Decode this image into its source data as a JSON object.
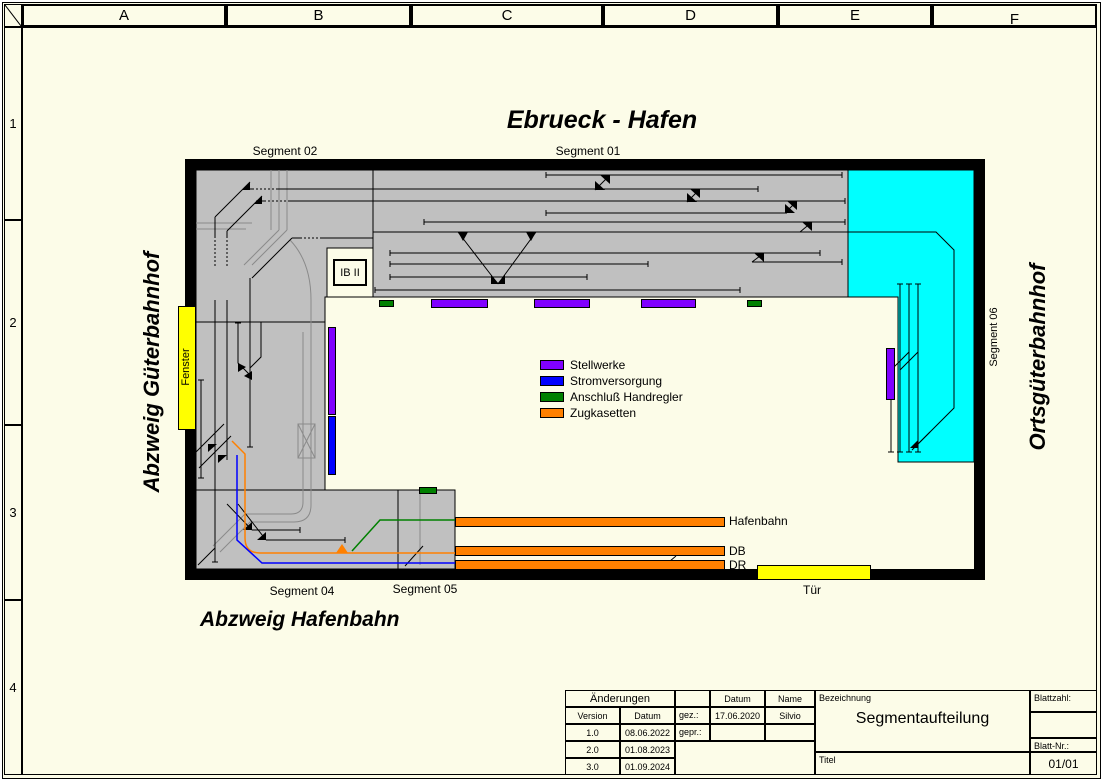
{
  "frame": {
    "columns": [
      "A",
      "B",
      "C",
      "D",
      "E",
      "F"
    ],
    "rows": [
      "1",
      "2",
      "3",
      "4"
    ]
  },
  "title": "Ebrueck - Hafen",
  "plan": {
    "segments": {
      "s01": "Segment 01",
      "s02": "Segment 02",
      "s04": "Segment 04",
      "s05": "Segment 05",
      "s06": "Segment 06"
    },
    "stations": {
      "left": "Abzweig Güterbahnhof",
      "right": "Ortsgüterbahnhof",
      "bottom": "Abzweig Hafenbahn"
    },
    "room": {
      "window": "Fenster",
      "door": "Tür"
    },
    "box_label": "IB II",
    "cassettes": {
      "c1": "Hafenbahn",
      "c2": "DB",
      "c3": "DR"
    }
  },
  "legend": {
    "items": [
      {
        "label": "Stellwerke",
        "color": "#8000FF"
      },
      {
        "label": "Stromversorgung",
        "color": "#0000FF"
      },
      {
        "label": "Anschluß Handregler",
        "color": "#008000"
      },
      {
        "label": "Zugkasetten",
        "color": "#FF8000"
      }
    ]
  },
  "colors": {
    "stellwerk": "#8000FF",
    "strom": "#0000FF",
    "handregler": "#008000",
    "zugkasetten": "#FF8000",
    "room_feature": "#FFFF00",
    "segment_fill": "#C0C0C0",
    "segment06_fill": "#00FFFF",
    "sheet_bg": "#FCFCE8"
  },
  "title_block": {
    "aenderungen": "Änderungen",
    "version_h": "Version",
    "datum_h": "Datum",
    "v1": "1.0",
    "d1": "08.06.2022",
    "v2": "2.0",
    "d2": "01.08.2023",
    "v3": "3.0",
    "d3": "01.09.2024",
    "gez": "gez.:",
    "gepr": "gepr.:",
    "datum_col": "Datum",
    "name_col": "Name",
    "gez_datum": "17.06.2020",
    "gez_name": "Silvio",
    "bezeichnung_label": "Bezeichnung",
    "bezeichnung": "Segmentaufteilung",
    "titel_label": "Titel",
    "blattzahl_label": "Blattzahl:",
    "blattnr_label": "Blatt-Nr.:",
    "blattnr": "01/01"
  }
}
